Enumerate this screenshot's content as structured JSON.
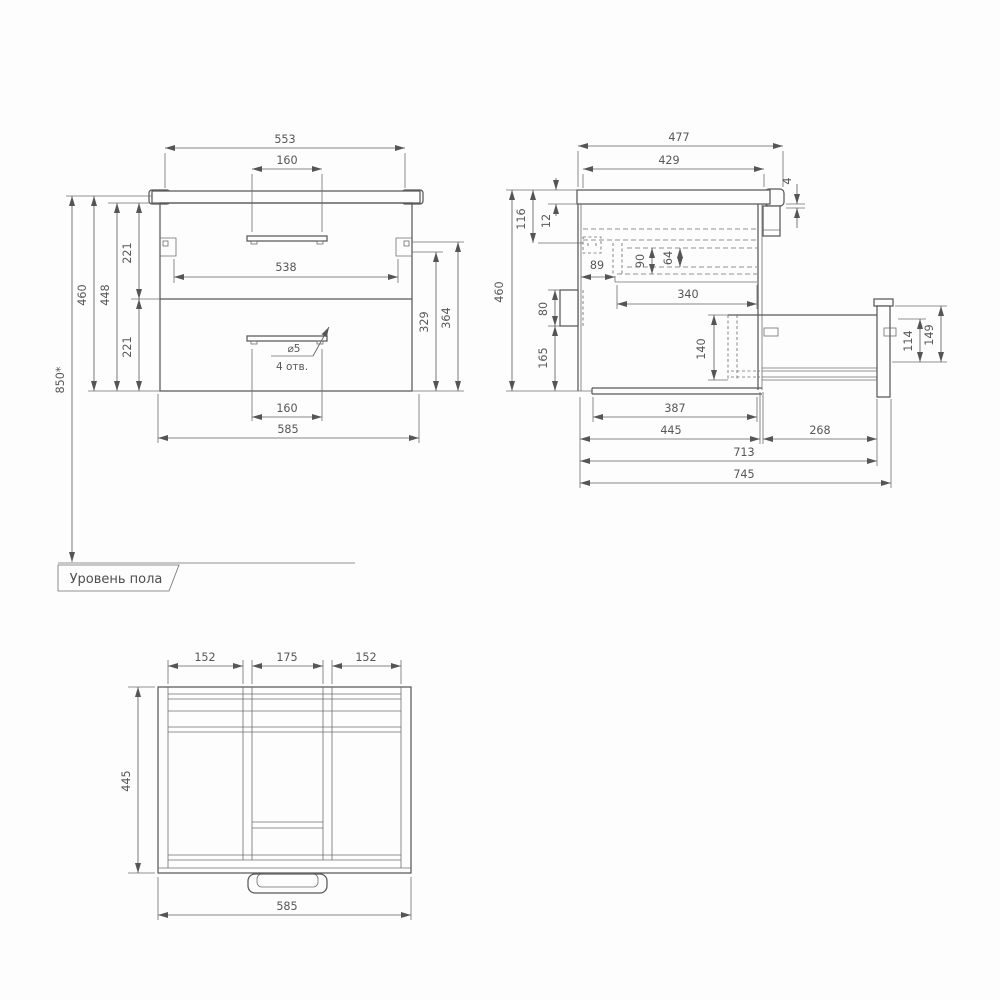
{
  "floor": {
    "label": "Уровень пола"
  },
  "front": {
    "d553": "553",
    "d160_top": "160",
    "d538": "538",
    "d221_upper": "221",
    "d221_lower": "221",
    "d448": "448",
    "d460": "460",
    "d850": "850*",
    "d329": "329",
    "d364": "364",
    "d160_bottom": "160",
    "d585": "585",
    "hole_dia": "⌀5",
    "hole_count": "4 отв."
  },
  "side": {
    "d477": "477",
    "d429": "429",
    "d4": "4",
    "d116": "116",
    "d12": "12",
    "d89": "89",
    "d90": "90",
    "d64": "64",
    "d340": "340",
    "d80": "80",
    "d165": "165",
    "d460": "460",
    "d140": "140",
    "d114": "114",
    "d149": "149",
    "d387": "387",
    "d445": "445",
    "d268": "268",
    "d713": "713",
    "d745": "745"
  },
  "top": {
    "d152_left": "152",
    "d175": "175",
    "d152_right": "152",
    "d445": "445",
    "d585": "585"
  }
}
